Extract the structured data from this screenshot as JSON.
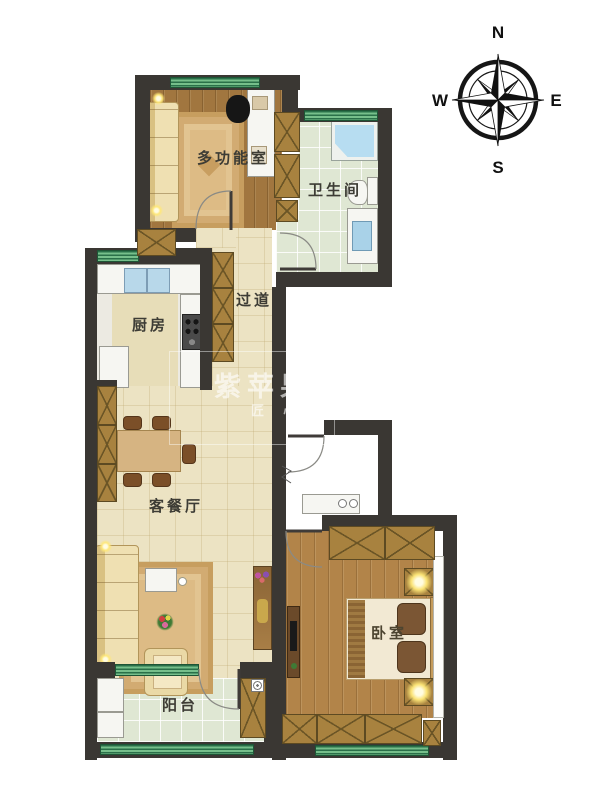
{
  "compass": {
    "north": "N",
    "south": "S",
    "east": "E",
    "west": "W"
  },
  "rooms": {
    "multi_function": {
      "label": "多功能室"
    },
    "bathroom": {
      "label": "卫生间"
    },
    "hallway": {
      "label": "过道"
    },
    "kitchen": {
      "label": "厨房"
    },
    "living_dining": {
      "label": "客餐厅"
    },
    "bedroom": {
      "label": "卧室"
    },
    "balcony": {
      "label": "阳台"
    }
  },
  "watermark": {
    "brand": "紫苹果",
    "tagline": "匠 心"
  },
  "palette": {
    "wall": "#3a3733",
    "window_green": "#76bf8b",
    "wood_floor": "#a1763f",
    "bedroom_floor": "#b28449",
    "tile_green": "#dfe7d3",
    "tile_beige": "#ece3c3",
    "cabinet_brown": "#a8823f"
  }
}
